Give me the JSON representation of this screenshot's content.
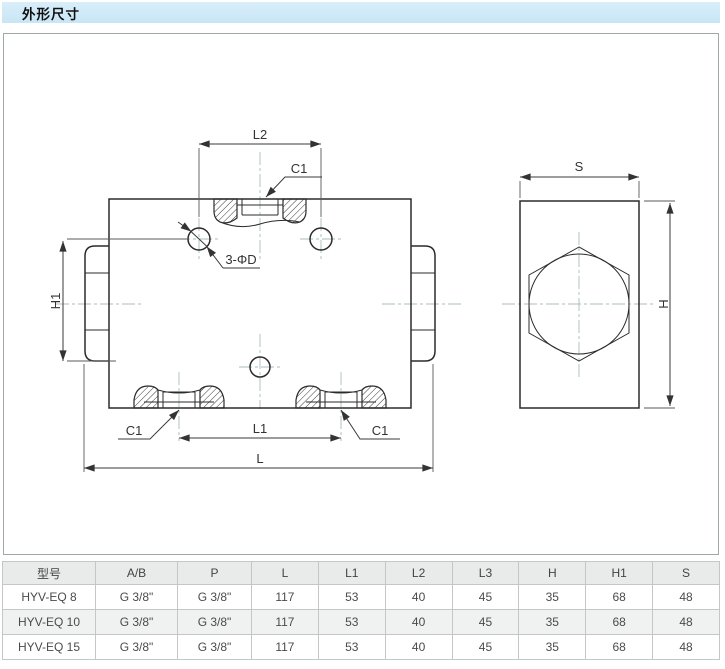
{
  "header": {
    "title": "外形尺寸"
  },
  "drawing": {
    "front": {
      "l2": "L2",
      "c1_top": "C1",
      "hole_note": "3-ΦD",
      "h1": "H1",
      "c1_bottom_left": "C1",
      "l1": "L1",
      "c1_bottom_right": "C1",
      "l": "L"
    },
    "side": {
      "s": "S",
      "h": "H"
    }
  },
  "table": {
    "headers": [
      "型号",
      "A/B",
      "P",
      "L",
      "L1",
      "L2",
      "L3",
      "H",
      "H1",
      "S"
    ],
    "rows": [
      [
        "HYV-EQ 8",
        "G 3/8\"",
        "G 3/8\"",
        "117",
        "53",
        "40",
        "45",
        "35",
        "68",
        "48"
      ],
      [
        "HYV-EQ 10",
        "G 3/8\"",
        "G 3/8\"",
        "117",
        "53",
        "40",
        "45",
        "35",
        "68",
        "48"
      ],
      [
        "HYV-EQ 15",
        "G 3/8\"",
        "G 3/8\"",
        "117",
        "53",
        "40",
        "45",
        "35",
        "68",
        "48"
      ]
    ]
  },
  "colors": {
    "header_bar_bg": "#cde9f6",
    "table_header_bg": "#e9eaea",
    "table_alt_row_bg": "#f0f1f1",
    "outline": "#2b2b2b",
    "centerline": "#a9bdbd"
  }
}
